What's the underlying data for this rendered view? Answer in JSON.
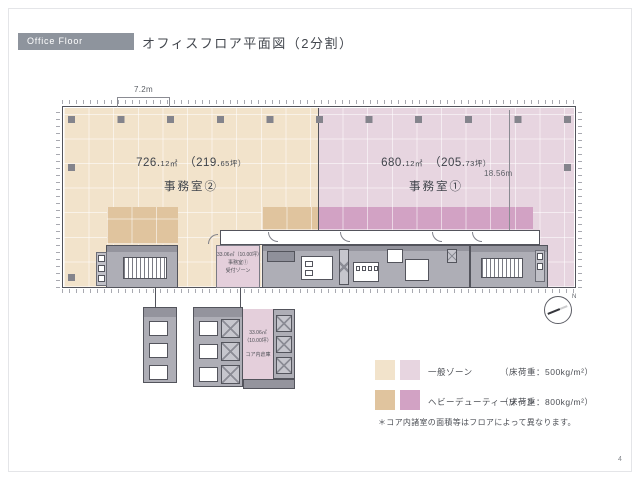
{
  "header": {
    "badge": "Office Floor",
    "title": "オフィスフロア平面図（2分割）"
  },
  "plan": {
    "dim_top": "7.2m",
    "dim_right": "18.56m",
    "north_label": "N",
    "room2": {
      "sqm_main": "726.",
      "sqm_small": "12㎡",
      "tsubo_main": "（219.",
      "tsubo_small": "65坪）",
      "name": "事務室②"
    },
    "room1": {
      "sqm_main": "680.",
      "sqm_small": "12㎡",
      "tsubo_main": "（205.",
      "tsubo_small": "73坪）",
      "name": "事務室①"
    },
    "reception": {
      "line1": "33.06㎡（10.00坪）",
      "line2": "事務室①",
      "line3": "受付ゾーン"
    },
    "core_room": {
      "line1": "33.06㎡",
      "line2": "（10.00坪）",
      "line3": "コア内倉庫"
    }
  },
  "legend": {
    "rows": [
      {
        "label": "一般ゾーン",
        "load": "（床荷重：500kg/m²）",
        "colors": [
          "#f2e3cb",
          "#e7d5e0"
        ]
      },
      {
        "label": "ヘビーデューティーゾーン",
        "load": "（床荷重：800kg/m²）",
        "colors": [
          "#e0c49e",
          "#d2a2c4"
        ]
      }
    ],
    "note": "＊コア内諸室の面積等はフロアによって異なります。"
  },
  "page_number": "4",
  "colors": {
    "badge_bg": "#8e949d",
    "zone_general_beige": "#f2e3cb",
    "zone_general_pink": "#e7d5e0",
    "zone_heavy_beige": "#e0c49e",
    "zone_heavy_pink": "#d2a2c4",
    "room_pink": "#e4cfdb"
  }
}
